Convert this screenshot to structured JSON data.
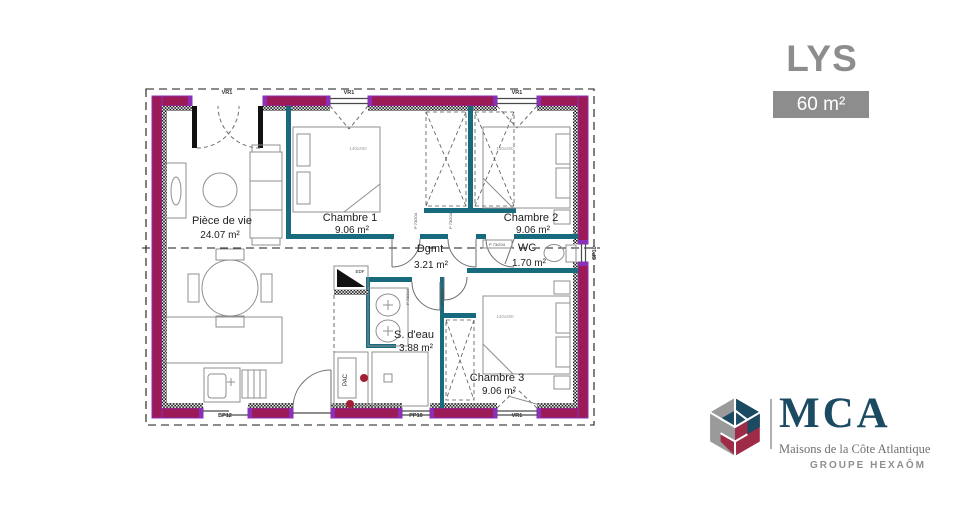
{
  "header": {
    "title": "LYS",
    "area_badge": "60 m²"
  },
  "plan": {
    "rooms": [
      {
        "label": "Pièce de vie",
        "area": "24.07 m²"
      },
      {
        "label": "Chambre 1",
        "area": "9.06 m²"
      },
      {
        "label": "Chambre 2",
        "area": "9.06 m²"
      },
      {
        "label": "Dgmt",
        "area": "3.21 m²"
      },
      {
        "label": "WC",
        "area": "1.70 m²"
      },
      {
        "label": "S. d'eau",
        "area": "3.88 m²"
      },
      {
        "label": "Chambre 3",
        "area": "9.06 m²"
      }
    ],
    "openings": {
      "top": [
        "VR1",
        "VR1",
        "VR1"
      ],
      "bottom": [
        "BP12",
        "PP10",
        "VR1"
      ],
      "right": [
        "SP10"
      ]
    },
    "bed_size": "140x200",
    "door_label": "P 73/204",
    "equipment": {
      "electrical": "EDF",
      "heat_pump": "PAC"
    }
  },
  "branding": {
    "brand": "MCA",
    "tagline": "Maisons de la Côte Atlantique",
    "group": "GROUPE HEXAÔM"
  },
  "colors": {
    "exterior_wall": "#9c1b57",
    "wall_jamb": "#8b2fb8",
    "partition": "#176b7d",
    "brand_navy": "#1b4a63",
    "brand_burgundy": "#9e2b47",
    "brand_gray": "#8d8d8d",
    "accent_red": "#a31f34"
  }
}
